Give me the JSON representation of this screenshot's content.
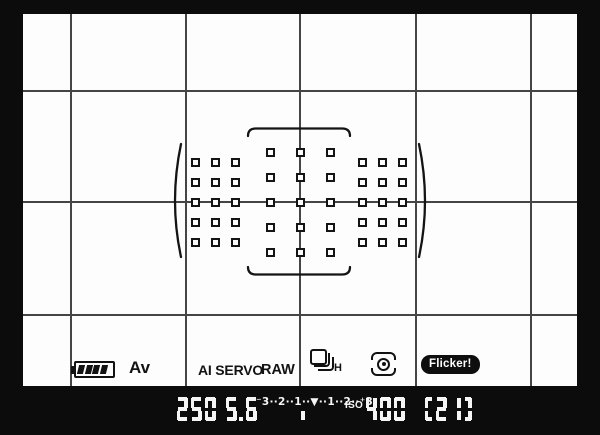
{
  "colors": {
    "frame_bg": "#0c0c0c",
    "screen_bg": "#fdfdfd",
    "grid_line": "#454545",
    "ink": "#121212",
    "readout": "#f5f5f5"
  },
  "status_bar": {
    "battery": {
      "icon": "battery-icon",
      "bars": 4
    },
    "mode_label": "Av",
    "af_mode_label": "AI SERVO",
    "quality_label": "RAW",
    "drive_mode": "continuous-shooting-high",
    "drive_speed_label": "H",
    "metering_mode": "evaluative",
    "flicker_label": "Flicker!"
  },
  "readout": {
    "shutter_speed": "250",
    "aperture": "5.6",
    "meter_scale": "⁻3··2··1··▼··1··2··⁺3",
    "meter_indicator_position": "0",
    "iso_label": "ISO",
    "iso_value": "400",
    "burst_count": "(21)"
  },
  "af_grid": {
    "point_count": 45,
    "groups": [
      {
        "name": "left",
        "cols": [
          172,
          192,
          212
        ],
        "rows": [
          148,
          168,
          188,
          208,
          228
        ]
      },
      {
        "name": "center",
        "cols": [
          247,
          277,
          307
        ],
        "rows": [
          138,
          163,
          188,
          213,
          238
        ]
      },
      {
        "name": "right",
        "cols": [
          339,
          359,
          379
        ],
        "rows": [
          148,
          168,
          188,
          208,
          228
        ]
      }
    ]
  }
}
